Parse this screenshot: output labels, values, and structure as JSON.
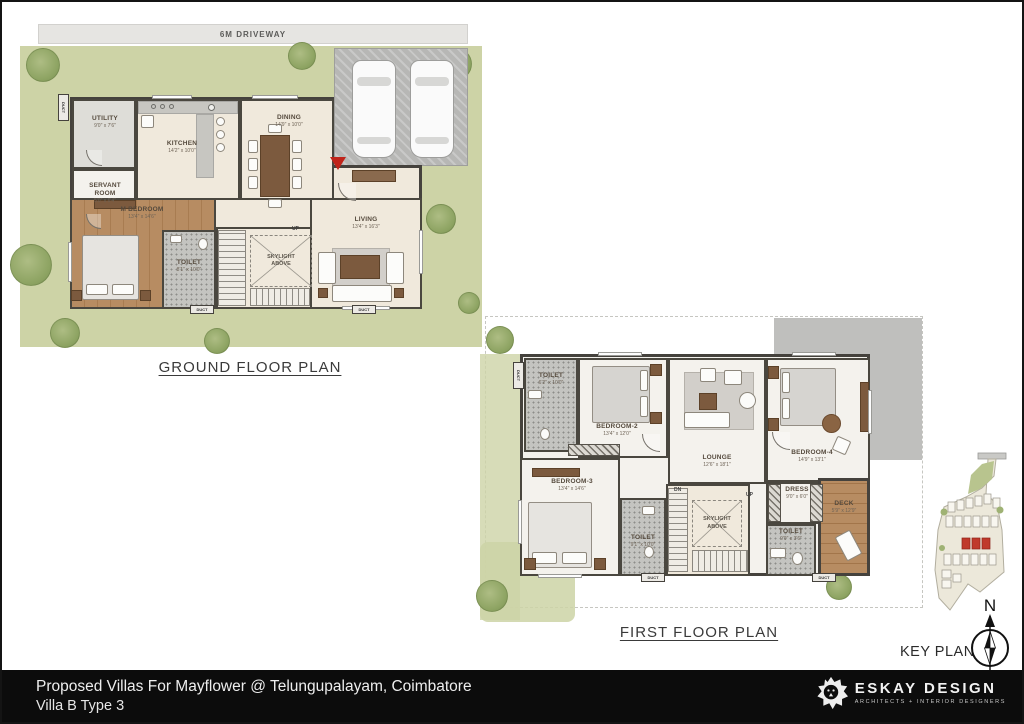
{
  "ground_floor": {
    "title": "GROUND FLOOR PLAN",
    "driveway_label": "6M DRIVEWAY",
    "up_label": "UP",
    "duct_label": "DUCT",
    "skylight_label": "SKYLIGHT ABOVE",
    "rooms": {
      "utility": {
        "name": "UTILITY",
        "dims": "9'0\" x 7'6\""
      },
      "servant": {
        "name": "SERVANT ROOM",
        "dims": "5'0\" x 6'4\""
      },
      "kitchen": {
        "name": "KITCHEN",
        "dims": "14'2\" x 10'0\""
      },
      "dining": {
        "name": "DINING",
        "dims": "14'9\" x 10'0\""
      },
      "m_bedroom": {
        "name": "M BEDROOM",
        "dims": "13'4\" x 14'6\""
      },
      "toilet": {
        "name": "TOILET",
        "dims": "8'1\" x 10'0\""
      },
      "living": {
        "name": "LIVING",
        "dims": "13'4\" x 16'3\""
      }
    }
  },
  "first_floor": {
    "title": "FIRST FLOOR PLAN",
    "up_label": "UP",
    "dn_label": "DN",
    "duct_label": "DUCT",
    "skylight_label": "SKYLIGHT ABOVE",
    "rooms": {
      "toilet_top": {
        "name": "TOILET",
        "dims": "6'2\" x 10'0\""
      },
      "bedroom2": {
        "name": "BEDROOM-2",
        "dims": "13'4\" x 12'0\""
      },
      "lounge": {
        "name": "LOUNGE",
        "dims": "12'6\" x 18'1\""
      },
      "bedroom4": {
        "name": "BEDROOM-4",
        "dims": "14'9\" x 13'1\""
      },
      "bedroom3": {
        "name": "BEDROOM-3",
        "dims": "13'4\" x 14'6\""
      },
      "toilet_mid": {
        "name": "TOILET",
        "dims": "9'1\" x 10'0\""
      },
      "dress": {
        "name": "DRESS",
        "dims": "9'0\" x 6'0\""
      },
      "toilet_small": {
        "name": "TOILET",
        "dims": "9'0\" x 3'6\""
      },
      "deck": {
        "name": "DECK",
        "dims": "5'9\" x 12'9\""
      }
    }
  },
  "key_plan": {
    "label": "KEY PLAN",
    "north_label": "N"
  },
  "footer": {
    "project_line": "Proposed Villas For Mayflower @ Telungupalayam, Coimbatore",
    "villa_line": "Villa B Type 3",
    "logo_name": "ESKAY DESIGN",
    "logo_tagline": "ARCHITECTS  +  INTERIOR  DESIGNERS"
  },
  "colors": {
    "entry_marker_red": "#c0241a",
    "site_green": "#cdd3a6",
    "wall_dark": "#45423d",
    "keyplan_highlight_red": "#c0392b"
  }
}
